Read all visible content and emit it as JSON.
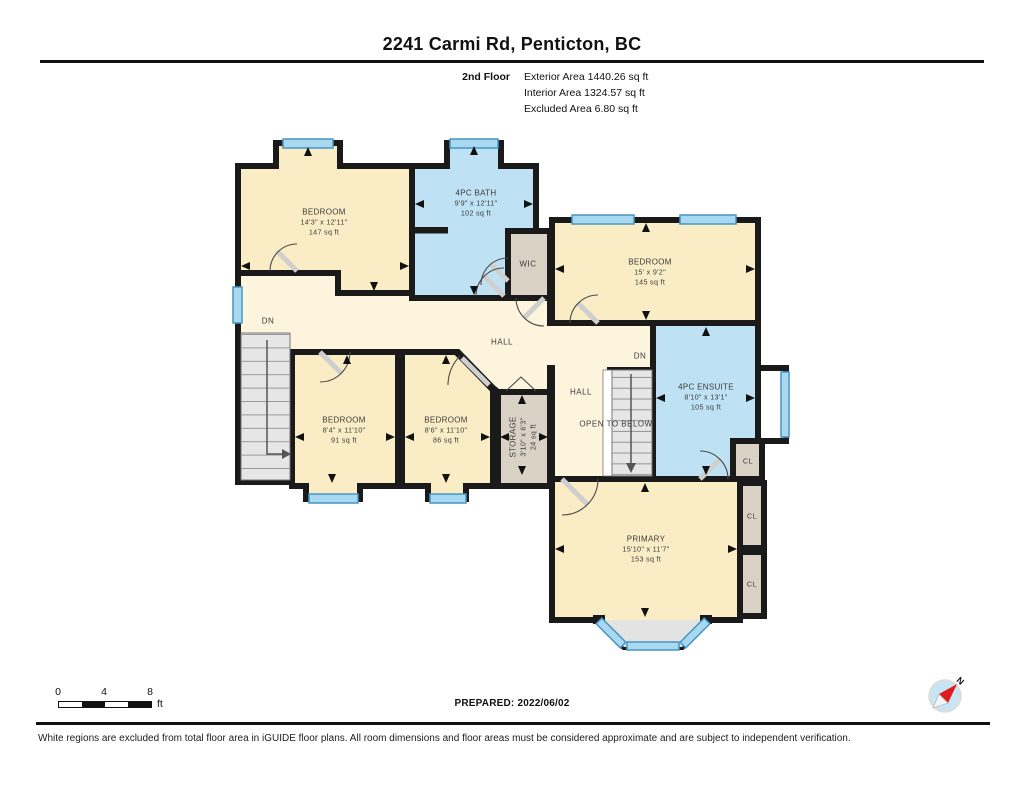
{
  "title": "2241 Carmi Rd, Penticton, BC",
  "floor_info": {
    "floor": "2nd Floor",
    "exterior": "Exterior Area 1440.26 sq ft",
    "interior": "Interior Area 1324.57 sq ft",
    "excluded": "Excluded Area 6.80 sq ft"
  },
  "rooms": {
    "bedroom_tl": {
      "name": "BEDROOM",
      "dims": "14'3\" x 12'11\"",
      "area": "147 sq ft"
    },
    "bath": {
      "name": "4PC BATH",
      "dims": "9'9\" x 12'11\"",
      "area": "102 sq ft"
    },
    "bedroom_r": {
      "name": "BEDROOM",
      "dims": "15' x 9'2\"",
      "area": "145 sq ft"
    },
    "ensuite": {
      "name": "4PC ENSUITE",
      "dims": "8'10\" x 13'1\"",
      "area": "105 sq ft"
    },
    "bedroom_m1": {
      "name": "BEDROOM",
      "dims": "8'4\" x 11'10\"",
      "area": "91 sq ft"
    },
    "bedroom_m2": {
      "name": "BEDROOM",
      "dims": "8'6\" x 11'10\"",
      "area": "86 sq ft"
    },
    "storage": {
      "name": "STORAGE",
      "dims": "3'10\" x 6'3\"",
      "area": "24 sq ft"
    },
    "primary": {
      "name": "PRIMARY",
      "dims": "15'10\" x 11'7\"",
      "area": "153 sq ft"
    }
  },
  "labels": {
    "wic": "WIC",
    "hall_main": "HALL",
    "hall_right": "HALL",
    "dn_left": "DN",
    "dn_right": "DN",
    "open_below": "OPEN TO BELOW",
    "cl1": "CL",
    "cl2": "CL",
    "cl3": "CL"
  },
  "scale_bar": {
    "zero": "0",
    "four": "4",
    "eight": "8",
    "unit": "ft"
  },
  "footer": {
    "prepared": "PREPARED: 2022/06/02",
    "north": "N",
    "disclaimer": "White regions are excluded from total floor area in iGUIDE floor plans. All room dimensions and floor areas must be considered approximate and are subject to independent verification."
  },
  "colors": {
    "room_cream": "#FAEDC6",
    "hall_cream": "#FCF4DC",
    "room_blue": "#BEE2F4",
    "room_gray": "#D9D2C5",
    "wall": "#1A1A1A",
    "window_fill": "#A9D9F0",
    "window_stroke": "#4796C4"
  }
}
